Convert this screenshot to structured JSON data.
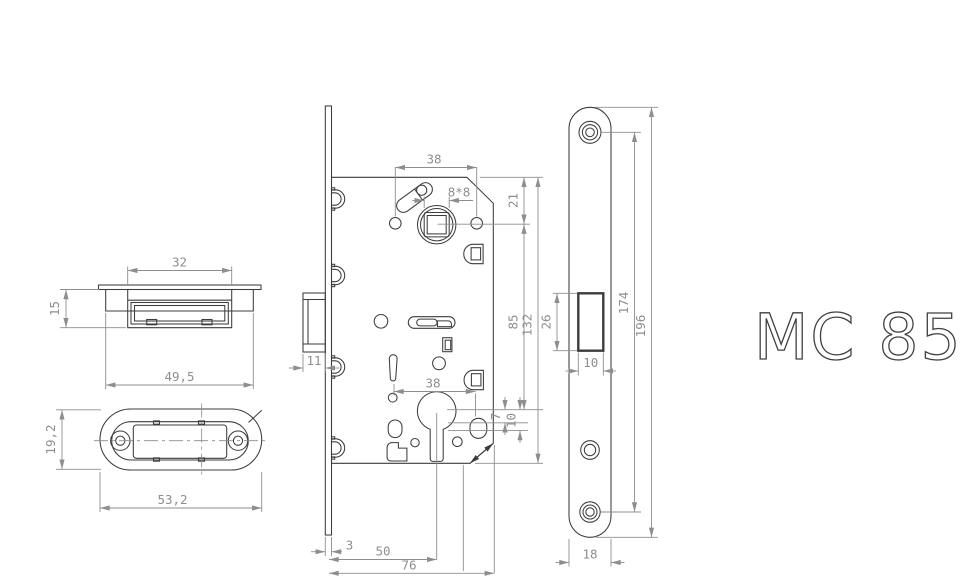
{
  "title": "MC 85",
  "colors": {
    "line": "#3c3c3c",
    "dim": "#8e8e8e",
    "background": "#ffffff"
  },
  "views": {
    "strike_box_side": {
      "label": "strike-box-side-view",
      "dims": {
        "slot_width": "32",
        "body_width": "49,5",
        "depth": "15"
      }
    },
    "strike_plate_plan": {
      "label": "strike-plate-plan-view",
      "dims": {
        "length": "53,2",
        "width": "19,2"
      }
    },
    "lock_body_front": {
      "label": "lock-body-front-view",
      "dims": {
        "top_hole_spacing": "38",
        "spindle_square": "8*8",
        "edge_to_spindle": "21",
        "spindle_to_cylinder": "85",
        "case_height": "132",
        "bottom_hole_spacing": "38",
        "latch_projection": "11",
        "offset_small": "7",
        "offset_large": "10",
        "plate_thickness": "3",
        "backset": "50",
        "depth": "76"
      }
    },
    "faceplate_front": {
      "label": "faceplate-front-view",
      "dims": {
        "cutout_height": "26",
        "cutout_width": "10",
        "hole_spacing": "174",
        "length": "196",
        "width": "18"
      }
    }
  }
}
